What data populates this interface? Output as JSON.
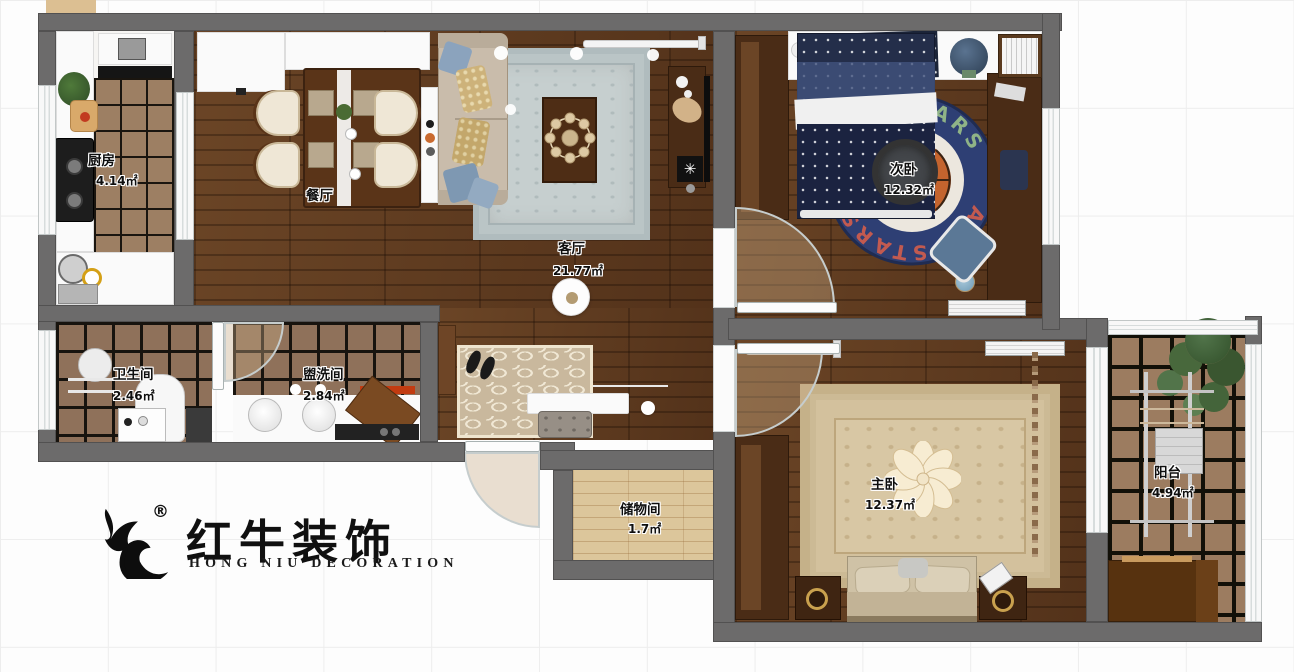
{
  "logo": {
    "brand_cn": "红牛装饰",
    "brand_en": "HONG NIU DECORATION",
    "registered_mark": "®"
  },
  "rooms": {
    "kitchen": {
      "name": "厨房",
      "area": "4.14㎡"
    },
    "dining": {
      "name": "餐厅",
      "area": ""
    },
    "living": {
      "name": "客厅",
      "area": "21.77㎡"
    },
    "bedroom2": {
      "name": "次卧",
      "area": "12.32㎡"
    },
    "bathroom": {
      "name": "卫生间",
      "area": "2.46㎡"
    },
    "washroom": {
      "name": "盥洗间",
      "area": "2.84㎡"
    },
    "storage": {
      "name": "储物间",
      "area": "1.7㎡"
    },
    "master": {
      "name": "主卧",
      "area": "12.37㎡"
    },
    "balcony": {
      "name": "阳台",
      "area": "4.94㎡"
    }
  },
  "rug": {
    "top_text": "ALL STARS",
    "bottom_text": "ALL STARS"
  },
  "poster": {
    "line1": "SOMETIMES",
    "line2": "MAZE"
  },
  "colors": {
    "wall": "#6c6b6b",
    "wood_dark": "#5e3c20",
    "wood_light": "#dcc69b",
    "tile": "#9b7b5f",
    "rug_navy": "#2e3f74",
    "rug_orange": "#c4642e",
    "rug_blue": "#c6cfcf",
    "rug_beige": "#d8c7a4"
  }
}
